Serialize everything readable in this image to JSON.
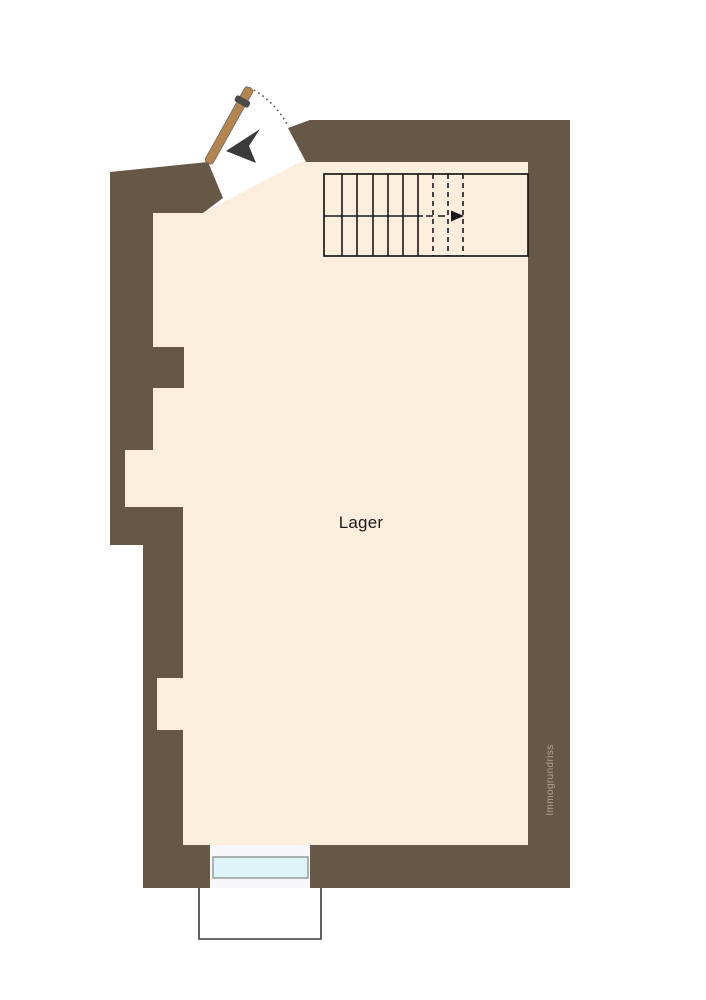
{
  "floorplan": {
    "room": {
      "label": "Lager"
    },
    "watermark": {
      "text": "Immogrundriss"
    },
    "colors": {
      "wall": "#675747",
      "floor": "#fbeedd",
      "door_leaf": "#b5854f",
      "door_swing": "#5a5a5a",
      "entry_arrow": "#3b3b3b",
      "stair_line": "#1a1a1a",
      "window_glass": "#dff4f6",
      "window_frame": "#9aa2a2",
      "exterior_outline": "#3a3a3a",
      "label_text": "#1b1b1b",
      "watermark_text": "#b4a48d",
      "background": "#ffffff"
    }
  }
}
